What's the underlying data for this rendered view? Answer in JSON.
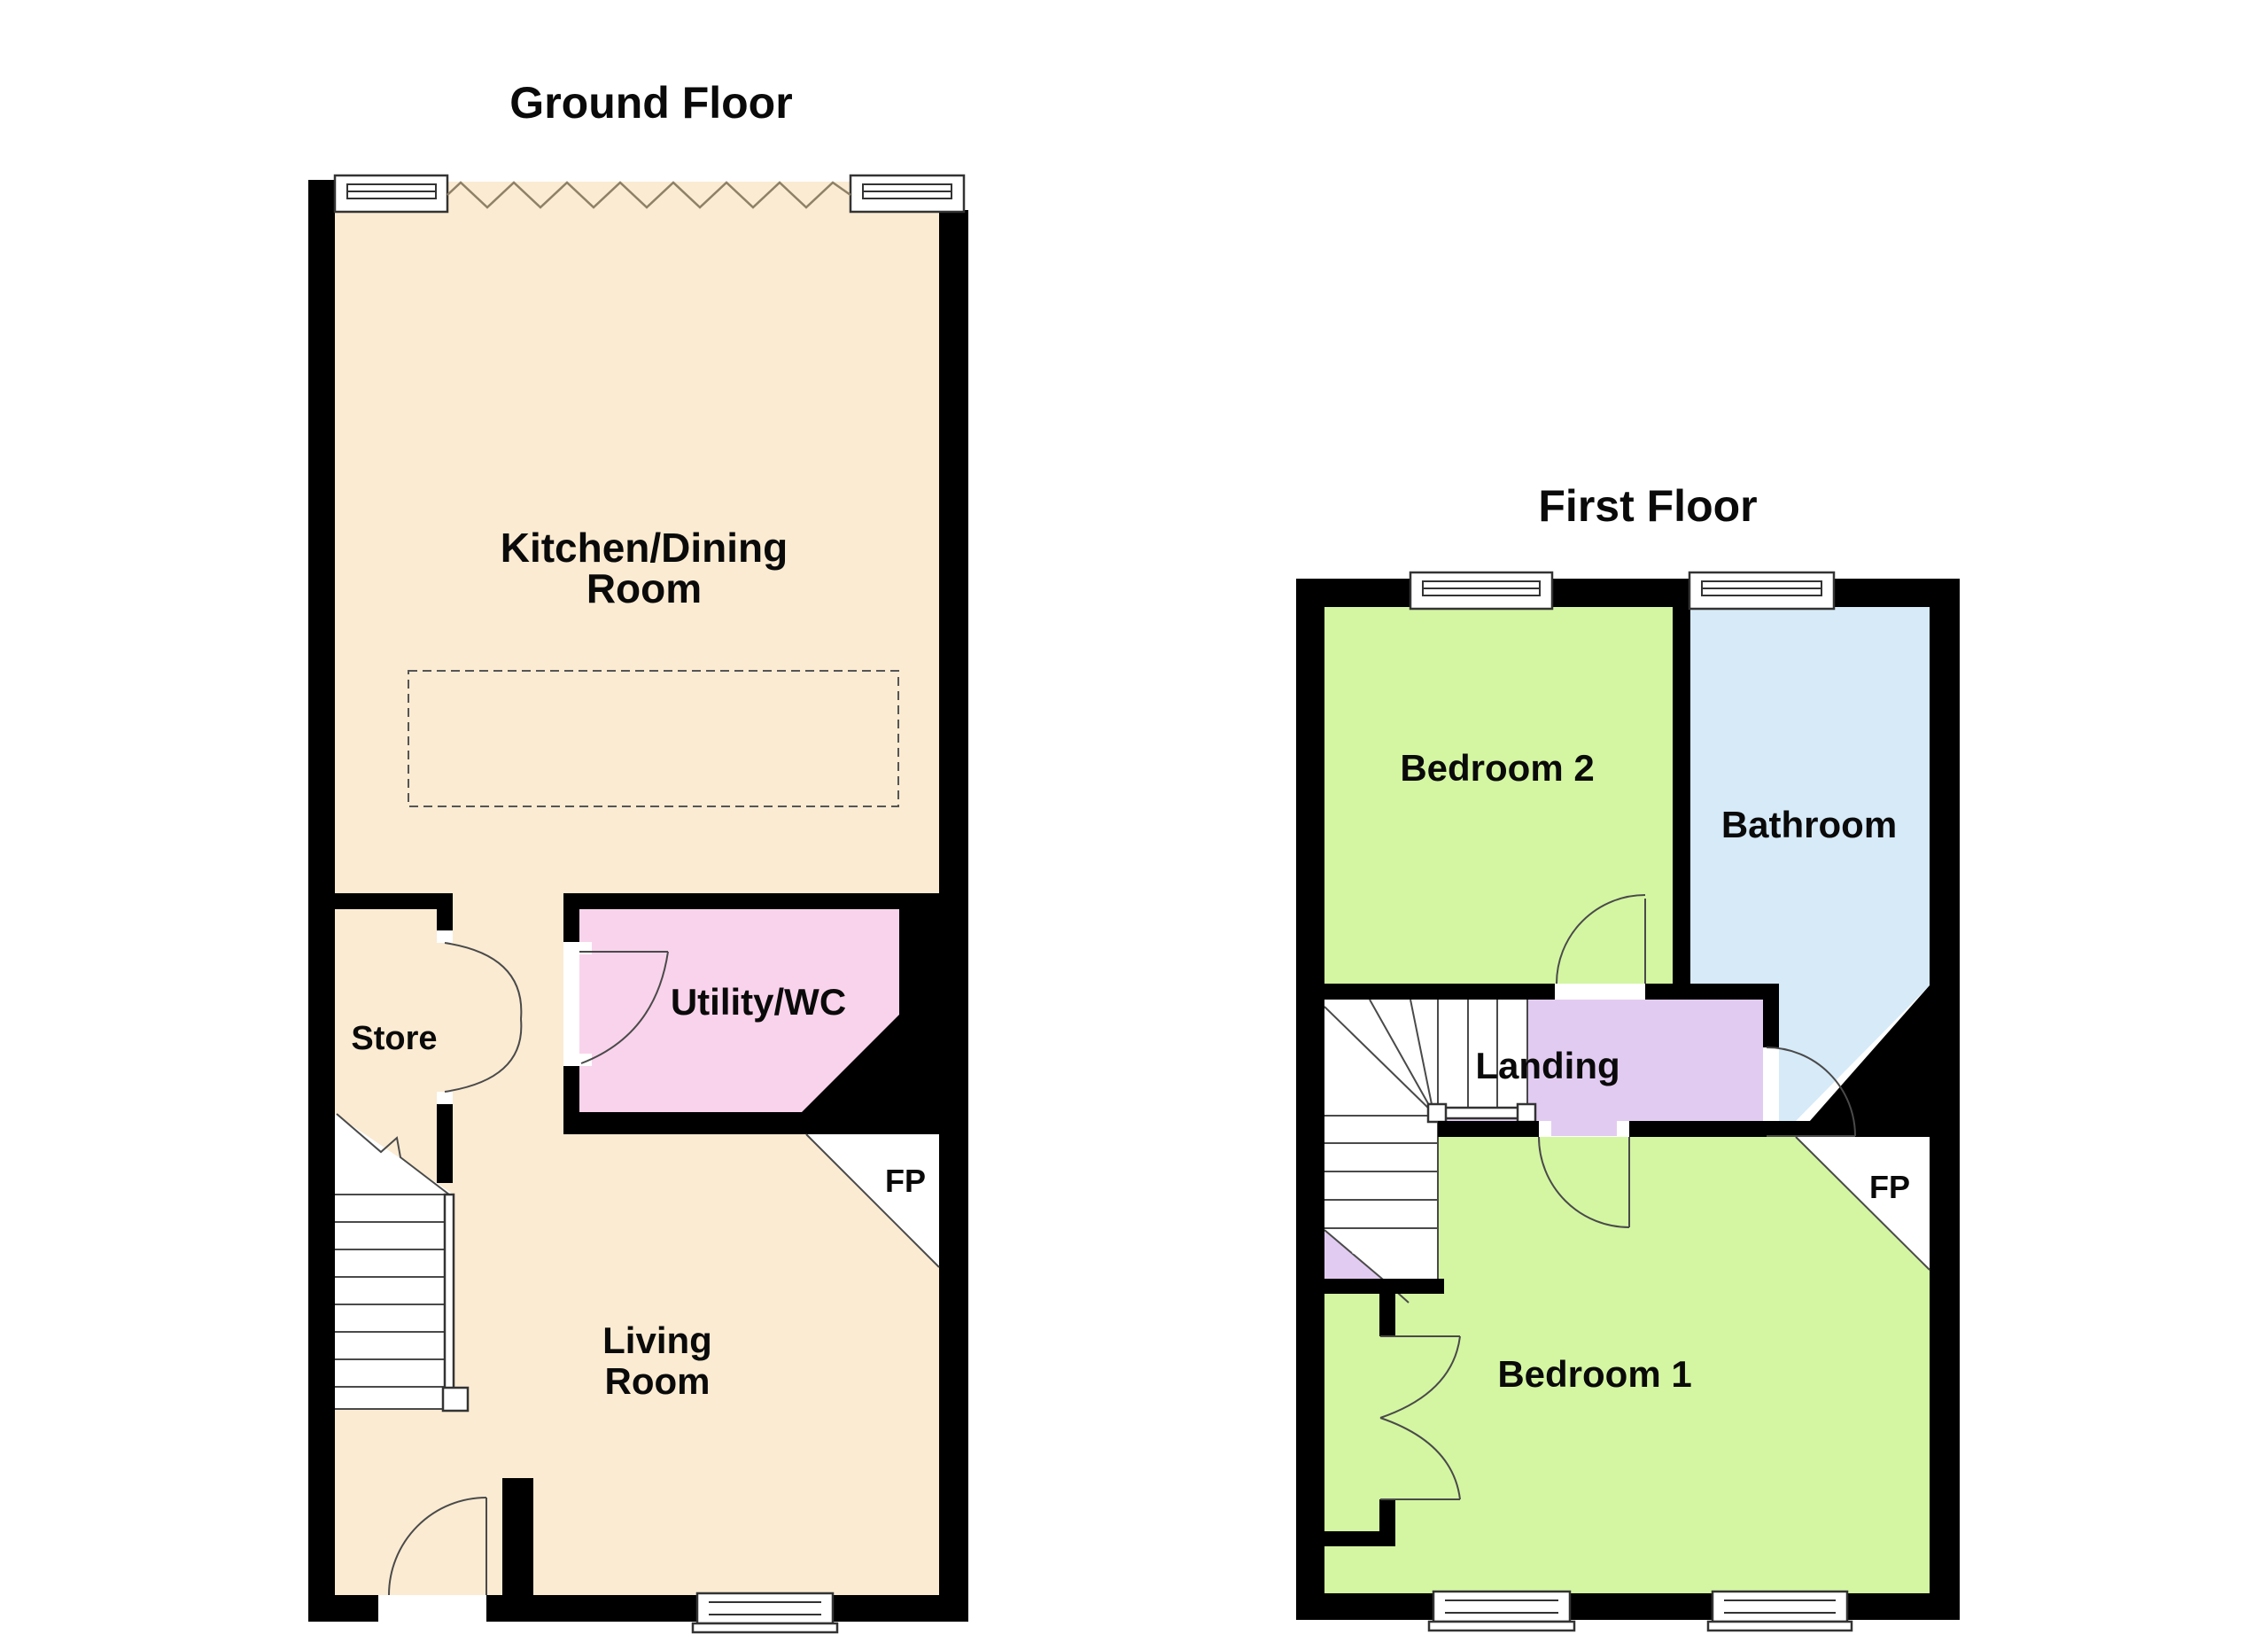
{
  "ground_floor": {
    "title": "Ground Floor",
    "kitchen_line1": "Kitchen/Dining",
    "kitchen_line2": "Room",
    "store_label": "Store",
    "utility_label": "Utility/WC",
    "living_line1": "Living",
    "living_line2": "Room",
    "fp_label": "FP"
  },
  "first_floor": {
    "title": "First Floor",
    "bedroom2_label": "Bedroom 2",
    "bathroom_label": "Bathroom",
    "landing_label": "Landing",
    "bedroom1_label": "Bedroom 1",
    "fp_label": "FP"
  },
  "colors": {
    "floor_cream": "#FAEBD2",
    "room_pink": "#F9D3EB",
    "room_green": "#D4F6A2",
    "room_blue": "#D6EAF8",
    "room_lavender": "#E2CBF1",
    "wall": "#000000",
    "zigzag": "#8E8168"
  }
}
